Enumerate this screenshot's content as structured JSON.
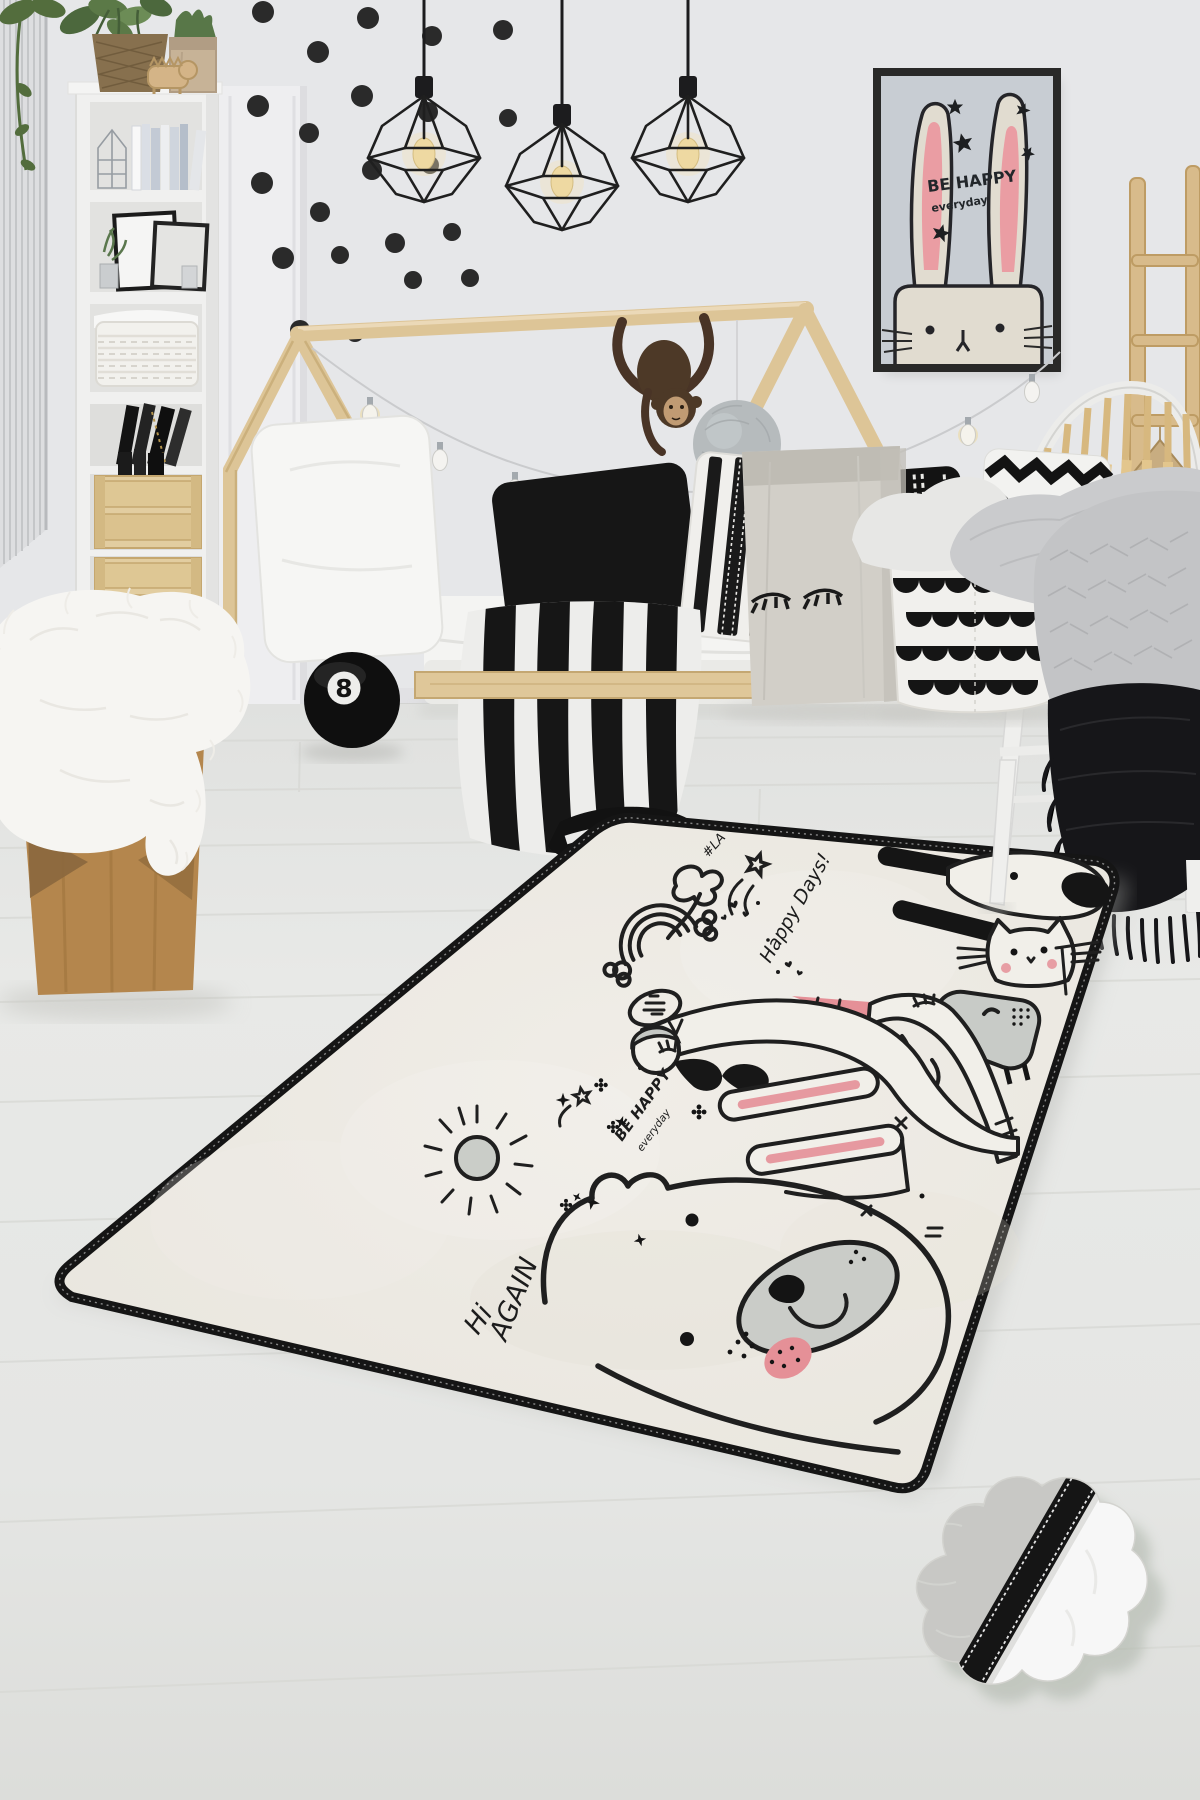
{
  "palette": {
    "wall": "#ebecee",
    "floor": "#e9eae7",
    "wood_light": "#e4cb9d",
    "wood_stool": "#b8894f",
    "rug_base": "#f2efe8",
    "rug_border": "#161616",
    "doodle_ink": "#202020",
    "accent_pink": "#ea939b",
    "doodle_gray": "#cdd0cb",
    "poster_background": "#cdd2d8",
    "textile_gray": "#c7c8ca",
    "textile_black": "#151517"
  },
  "poster": {
    "line1": "BE HAPPY",
    "line2": "everyday"
  },
  "eight_ball": {
    "number": "8"
  },
  "rug_texts": {
    "hashtag": "#LA",
    "happy_days": "Happy Days!",
    "be_happy": "BE HAPPY",
    "everyday": "everyday",
    "hi": "Hi",
    "again": "AGAIN"
  }
}
